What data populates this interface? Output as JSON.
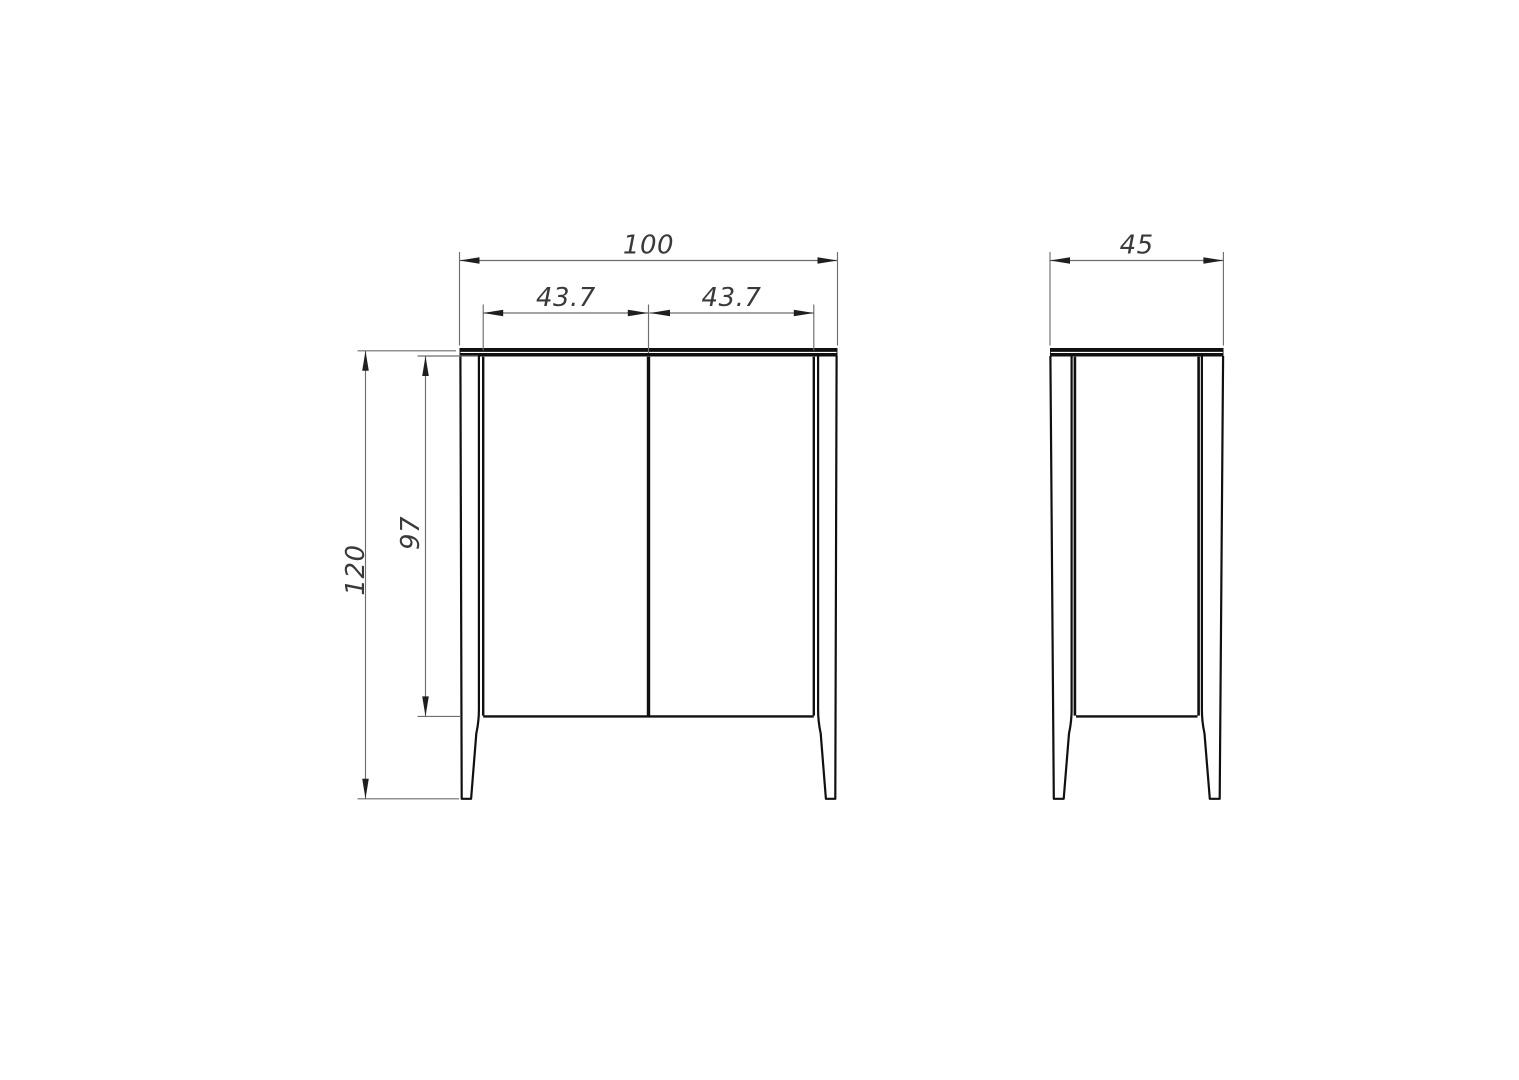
{
  "drawing": {
    "front_view": {
      "width_total": "100",
      "door_width_left": "43.7",
      "door_width_right": "43.7",
      "height_total": "120",
      "body_height": "97"
    },
    "side_view": {
      "depth": "45"
    },
    "style": {
      "background": "#ffffff",
      "object_line_color": "#101010",
      "dimension_line_color": "#6e6e6e",
      "arrow_color": "#1f1f1f",
      "label_color": "#3a3a3a"
    }
  }
}
